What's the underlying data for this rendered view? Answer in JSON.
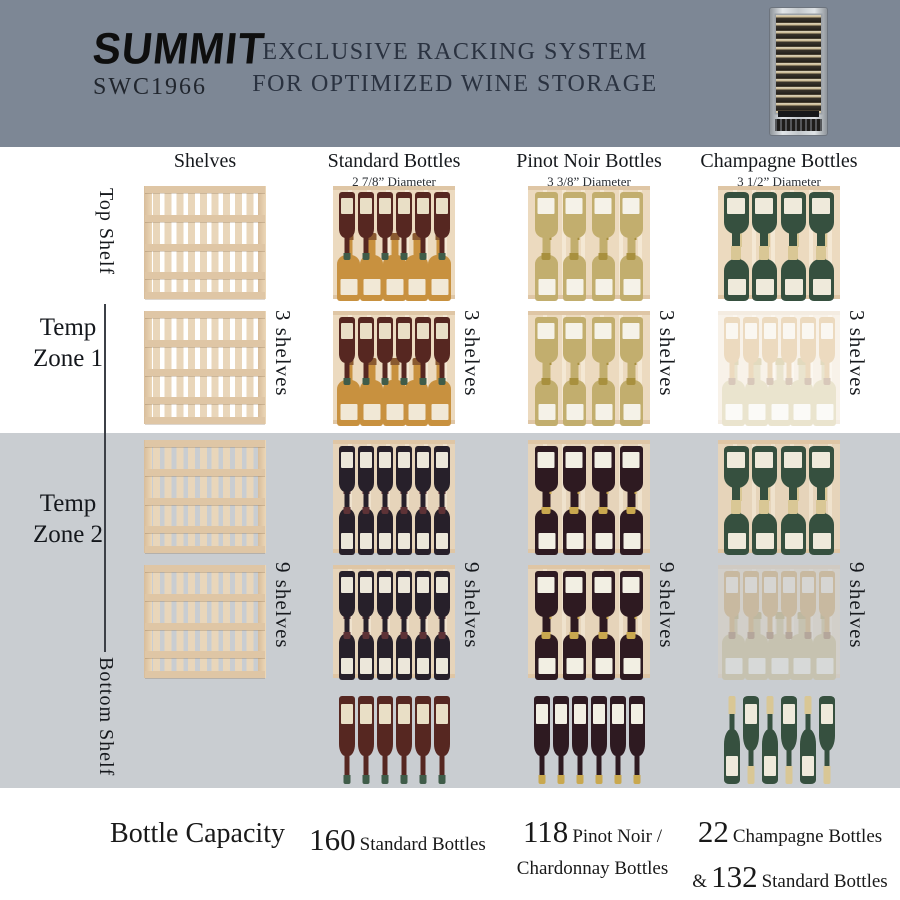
{
  "header": {
    "brand": "SUMMIT",
    "model": "SWC1966",
    "title_line1": "EXCLUSIVE RACKING SYSTEM",
    "title_line2": "FOR OPTIMIZED WINE STORAGE",
    "product_image": "wine-cooler-with-glass-door"
  },
  "columns": [
    {
      "label": "Shelves",
      "sub": ""
    },
    {
      "label": "Standard Bottles",
      "sub": "2 7/8” Diameter"
    },
    {
      "label": "Pinot Noir Bottles",
      "sub": "3 3/8” Diameter"
    },
    {
      "label": "Champagne Bottles",
      "sub": "3 1/2” Diameter"
    }
  ],
  "zones": [
    {
      "label_line1": "Temp",
      "label_line2": "Zone 1",
      "shelf_count_label": "3 shelves"
    },
    {
      "label_line1": "Temp",
      "label_line2": "Zone 2",
      "shelf_count_label": "9 shelves"
    }
  ],
  "side_labels": {
    "top": "Top Shelf",
    "bottom": "Bottom Shelf"
  },
  "capacity": {
    "title": "Bottle Capacity",
    "items": [
      {
        "num": "160",
        "text": "Standard Bottles"
      },
      {
        "num": "118",
        "text": "Pinot Noir /",
        "text2": "Chardonnay Bottles"
      },
      {
        "num": "22",
        "text": "Champagne Bottles",
        "amp": "&",
        "num2": "132",
        "text2": "Standard Bottles"
      }
    ]
  },
  "colors": {
    "header_bg": "#7d8795",
    "zone2_bg": "#c9cdd1",
    "wood": "#ecdabf",
    "wood_dark": "#dfc6a5",
    "title_text": "#2a3240",
    "dark_text": "#16191d"
  },
  "bottle_styles": {
    "burgundy": {
      "body": "#562721",
      "cap": "#3f5c49",
      "label": "#e9dfc6",
      "kind": "still"
    },
    "amber": {
      "body": "#c8913f",
      "cap": "#8a5a30",
      "label": "#f1e8d6",
      "kind": "still"
    },
    "darkred": {
      "body": "#27202a",
      "cap": "#5d3236",
      "label": "#ece7da",
      "kind": "still"
    },
    "whitewine": {
      "body": "#c2ae6e",
      "cap": "#a8903e",
      "label": "#f5f2e8",
      "kind": "still"
    },
    "pinot": {
      "body": "#2e1a21",
      "cap": "#c9a84f",
      "label": "#f2efe3",
      "kind": "still"
    },
    "champagne": {
      "body": "#36503f",
      "cap": "#d9c795",
      "label": "#efeadb",
      "kind": "champagne"
    }
  },
  "grid": {
    "cells": [
      {
        "c": 0,
        "r": 0,
        "kind": "shelf"
      },
      {
        "c": 0,
        "r": 1,
        "kind": "shelf"
      },
      {
        "c": 0,
        "r": 2,
        "kind": "shelf"
      },
      {
        "c": 0,
        "r": 3,
        "kind": "shelf"
      },
      {
        "c": 1,
        "r": 0,
        "kind": "rack",
        "top": {
          "style": "burgundy",
          "n": 6
        },
        "bottom": {
          "style": "amber",
          "n": 5
        }
      },
      {
        "c": 1,
        "r": 1,
        "kind": "rack",
        "top": {
          "style": "burgundy",
          "n": 6
        },
        "bottom": {
          "style": "amber",
          "n": 5
        }
      },
      {
        "c": 1,
        "r": 2,
        "kind": "rack",
        "top": {
          "style": "darkred",
          "n": 6
        },
        "bottom": {
          "style": "darkred",
          "n": 6
        }
      },
      {
        "c": 1,
        "r": 3,
        "kind": "rack",
        "top": {
          "style": "darkred",
          "n": 6
        },
        "bottom": {
          "style": "darkred",
          "n": 6
        }
      },
      {
        "c": 1,
        "r": 4,
        "kind": "row",
        "row": {
          "style": "burgundy",
          "n": 6,
          "orient": "down"
        }
      },
      {
        "c": 2,
        "r": 0,
        "kind": "rack",
        "top": {
          "style": "whitewine",
          "n": 4
        },
        "bottom": {
          "style": "whitewine",
          "n": 4
        }
      },
      {
        "c": 2,
        "r": 1,
        "kind": "rack",
        "top": {
          "style": "whitewine",
          "n": 4
        },
        "bottom": {
          "style": "whitewine",
          "n": 4
        }
      },
      {
        "c": 2,
        "r": 2,
        "kind": "rack",
        "top": {
          "style": "pinot",
          "n": 4
        },
        "bottom": {
          "style": "pinot",
          "n": 4
        }
      },
      {
        "c": 2,
        "r": 3,
        "kind": "rack",
        "top": {
          "style": "pinot",
          "n": 4
        },
        "bottom": {
          "style": "pinot",
          "n": 4
        }
      },
      {
        "c": 2,
        "r": 4,
        "kind": "row",
        "row": {
          "style": "pinot",
          "n": 6,
          "orient": "down"
        }
      },
      {
        "c": 3,
        "r": 0,
        "kind": "rack",
        "top": {
          "style": "champagne",
          "n": 4
        },
        "bottom": {
          "style": "champagne",
          "n": 4
        }
      },
      {
        "c": 3,
        "r": 1,
        "kind": "rack",
        "top": {
          "style": "amber",
          "n": 6
        },
        "bottom": {
          "style": "whitewine",
          "n": 5
        },
        "faded": true
      },
      {
        "c": 3,
        "r": 2,
        "kind": "rack",
        "top": {
          "style": "champagne",
          "n": 4
        },
        "bottom": {
          "style": "champagne",
          "n": 4
        }
      },
      {
        "c": 3,
        "r": 3,
        "kind": "rack",
        "top": {
          "style": "amber",
          "n": 6
        },
        "bottom": {
          "style": "whitewine",
          "n": 5
        },
        "faded": true
      },
      {
        "c": 3,
        "r": 4,
        "kind": "row",
        "row": {
          "style": "champagne",
          "n": 6,
          "orient": "alt"
        }
      }
    ]
  }
}
